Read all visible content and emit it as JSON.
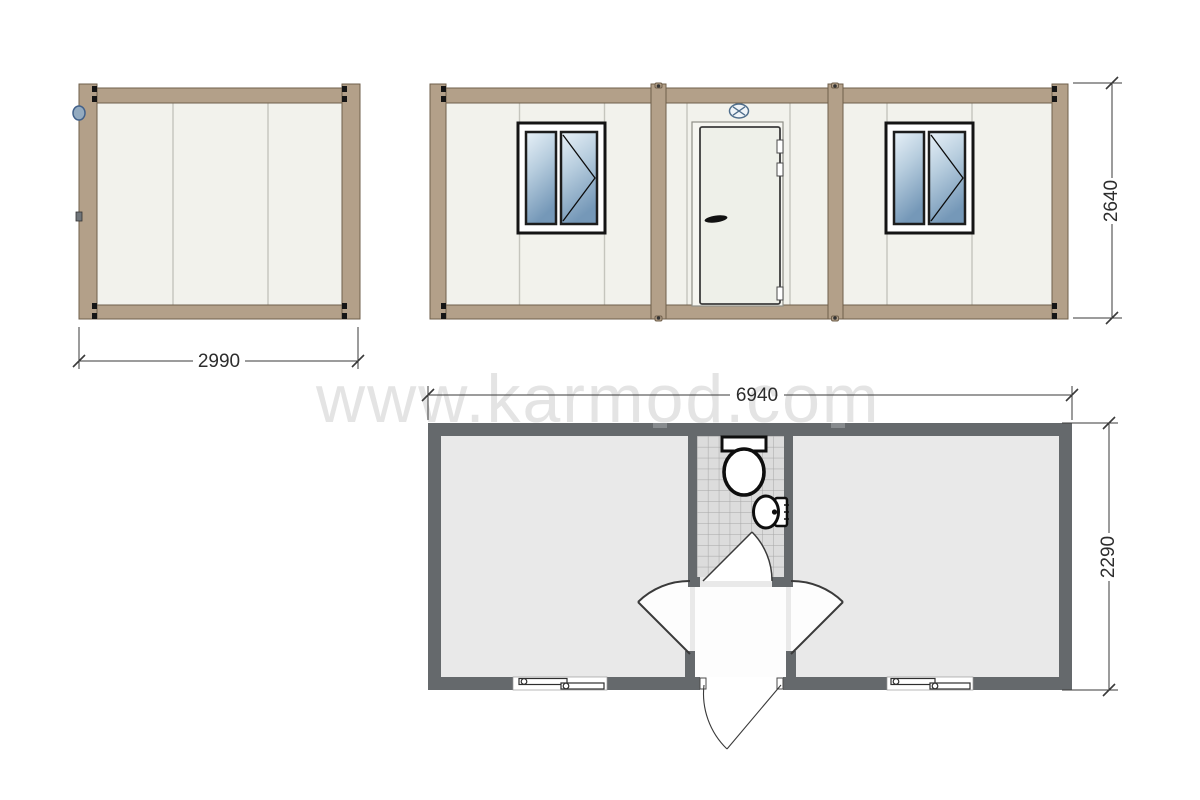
{
  "watermark": {
    "text": "www.karmod.com"
  },
  "views": {
    "side_elevation": {
      "width_mm": "2990"
    },
    "front_elevation": {
      "height_mm": "2640"
    },
    "floor_plan": {
      "width_mm": "6940",
      "height_mm": "2290"
    }
  },
  "colors": {
    "frame_tan": "#b3a089",
    "frame_border": "#6f5f4b",
    "panel_cream": "#f2f2ec",
    "glass_light": "#e8f1f8",
    "glass_mid": "#b7cdde",
    "glass_dark": "#7598b8",
    "wall_gray": "#65696c",
    "floor_gray": "#e9e9e9",
    "tile_gray": "#dcdcdc",
    "hall_white": "#fdfdfd",
    "dim_color": "#3a3a3a",
    "watermark_gray": "#e4e4e4",
    "vent_blue": "#4f6e8c"
  },
  "icons": {
    "vent": "vent-fan-icon",
    "toilet": "toilet-icon",
    "sink": "sink-icon",
    "window_plan": "sliding-window-icon",
    "window_elevation": "casement-window-icon",
    "door_elevation": "entry-door-icon",
    "hook": "lifting-hook-icon"
  }
}
